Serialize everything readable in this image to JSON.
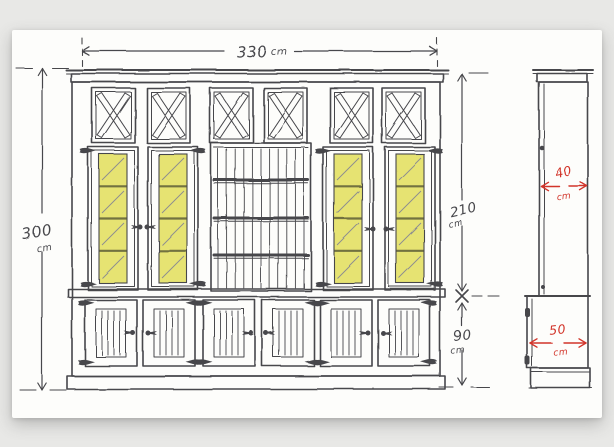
{
  "sketch": {
    "front_elevation": {
      "width_dim": {
        "value": "330",
        "unit": "cm"
      },
      "height_dim": {
        "value": "300",
        "unit": "cm"
      },
      "upper_section_dim": {
        "value": "210",
        "unit": "cm"
      },
      "lower_section_dim": {
        "value": "90",
        "unit": "cm"
      }
    },
    "side_elevation": {
      "upper_depth_dim": {
        "value": "40",
        "unit": "cm"
      },
      "lower_depth_dim": {
        "value": "50",
        "unit": "cm"
      }
    },
    "colors": {
      "ink": "#46464b",
      "red": "#d2342a",
      "glass": "#e6e372",
      "glass_line": "#72723f",
      "faint": "#8b8b90",
      "paper": "#fdfdfb",
      "background": "#e8e8e6"
    }
  }
}
